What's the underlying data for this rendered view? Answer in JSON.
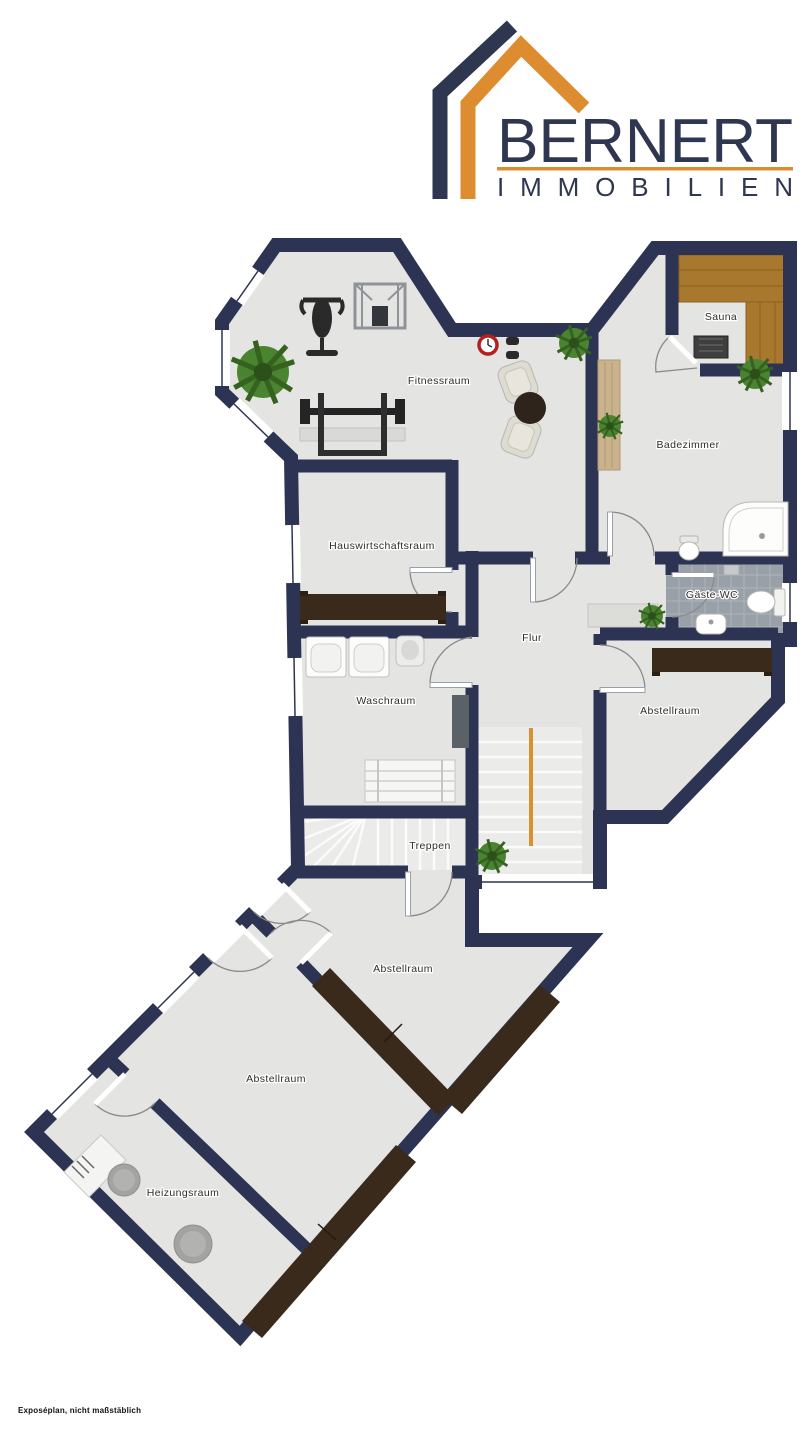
{
  "logo": {
    "brand": "BERNERT",
    "subtitle": "IMMOBILIEN",
    "icon": "house-roof-icon",
    "colors": {
      "navy": "#2e3650",
      "orange": "#dd8c2f"
    }
  },
  "floorplan": {
    "colors": {
      "wall": "#2d3453",
      "floor": "#e4e4e2",
      "window_white": "#ffffff",
      "sauna_wood": "#a9782f",
      "tile_gray": "#9aa0a8",
      "furniture_dark": "#3a2a1c",
      "plant_green": "#4a8430",
      "stair_rail_orange": "#d89030",
      "stair_tread": "#ebebe9"
    },
    "rooms": [
      {
        "label": "Fitnessraum",
        "x": 439,
        "y": 380
      },
      {
        "label": "Sauna",
        "x": 721,
        "y": 316
      },
      {
        "label": "Badezimmer",
        "x": 688,
        "y": 444
      },
      {
        "label": "Hauswirtschaftsraum",
        "x": 382,
        "y": 545
      },
      {
        "label": "Flur",
        "x": 532,
        "y": 637
      },
      {
        "label": "Gäste-WC",
        "x": 712,
        "y": 594
      },
      {
        "label": "Waschraum",
        "x": 386,
        "y": 700
      },
      {
        "label": "Abstellraum",
        "x": 670,
        "y": 710
      },
      {
        "label": "Treppen",
        "x": 430,
        "y": 845
      },
      {
        "label": "Abstellraum",
        "x": 403,
        "y": 968
      },
      {
        "label": "Abstellraum",
        "x": 276,
        "y": 1078
      },
      {
        "label": "Heizungsraum",
        "x": 183,
        "y": 1192
      }
    ]
  },
  "footer": {
    "note": "Exposéplan, nicht maßstäblich"
  }
}
